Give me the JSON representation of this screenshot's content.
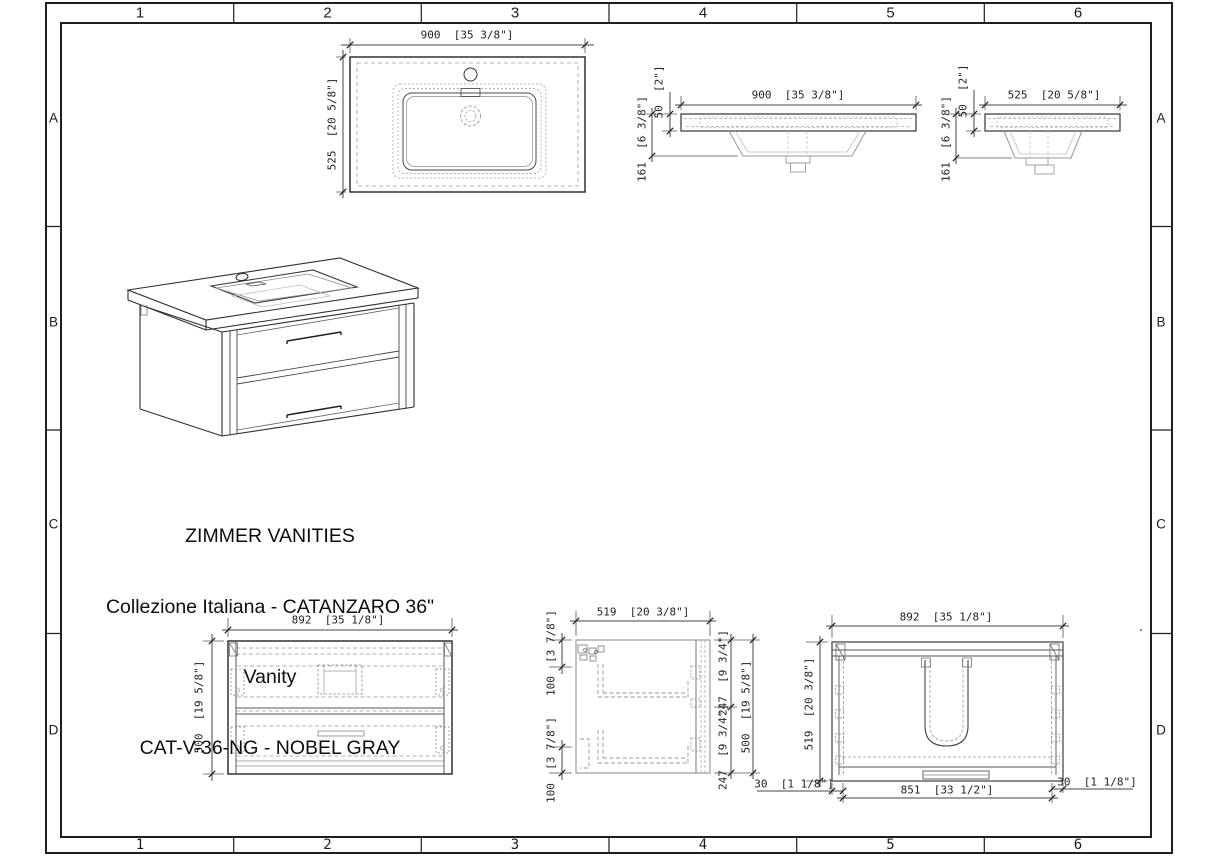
{
  "sheet": {
    "top_zones": [
      "1",
      "2",
      "3",
      "4",
      "5",
      "6"
    ],
    "bottom_zones": [
      "1",
      "2",
      "3",
      "4",
      "5",
      "6"
    ],
    "left_zones": [
      "A",
      "B",
      "C",
      "D"
    ],
    "right_zones": [
      "A",
      "B",
      "C",
      "D"
    ]
  },
  "title_block": {
    "line1": "ZIMMER VANITIES",
    "line2": "Collezione Italiana - CATANZARO 36\"",
    "line3": "Vanity",
    "line4": "CAT-V-36-NG - NOBEL GRAY"
  },
  "dims": {
    "sink_top_width": "900  [35 3/8\"]",
    "sink_top_depth": "525  [20 5/8\"]",
    "sink_front_width": "900  [35 3/8\"]",
    "sink_front_rim": "50  [2\"]",
    "sink_front_depth": "161  [6 3/8\"]",
    "sink_side_width": "525  [20 5/8\"]",
    "sink_side_rim": "50  [2\"]",
    "sink_side_depth": "161  [6 3/8\"]",
    "cab_front_width": "892  [35 1/8\"]",
    "cab_front_height": "500  [19 5/8\"]",
    "cab_side_depth": "519  [20 3/8\"]",
    "cab_side_top_gap": "100  [3 7/8\"]",
    "cab_side_bottom_gap": "100  [3 7/8\"]",
    "cab_side_upper": "247  [9 3/4\"]",
    "cab_side_lower": "247  [9 3/4\"]",
    "cab_side_height": "500  [19 5/8\"]",
    "cab_top_width": "892  [35 1/8\"]",
    "cab_top_depth": "519  [20 3/8\"]",
    "cab_top_inner_width": "851  [33 1/2\"]",
    "cab_top_left_gap": "30  [1 1/8\"]",
    "cab_top_right_gap": "30  [1 1/8\"]"
  },
  "colors": {
    "line": "#1f1f1f",
    "medium": "#555555",
    "hidden": "#999999",
    "faint": "#bbbbbb",
    "background": "#ffffff"
  }
}
